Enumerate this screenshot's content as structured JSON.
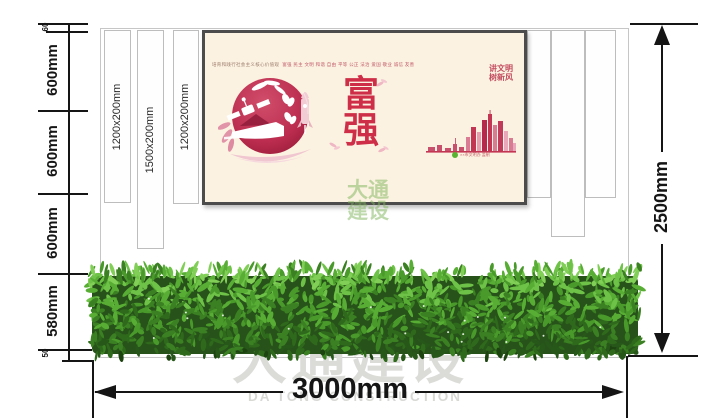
{
  "structure": {
    "slats": [
      {
        "label": "1200x200mm"
      },
      {
        "label": "1500x200mm"
      },
      {
        "label": "1200x200mm"
      }
    ]
  },
  "dimensions": {
    "left_top_small": "60",
    "left_segments": [
      "600mm",
      "600mm",
      "600mm",
      "580mm"
    ],
    "left_bottom_small": "50",
    "right_total": "2500mm",
    "bottom_total": "3000mm"
  },
  "poster": {
    "values_intro": "培育和践行社会主义核心价值观",
    "values_list": "富强 民主 文明 和谐 自由 平等 公正 法治 爱国 敬业 诚信 友善",
    "slogan": [
      "讲文明",
      "树新风"
    ],
    "main_word_top": "富",
    "main_word_bottom": "强",
    "credit": "××市文明办 监制"
  },
  "watermark": {
    "company_cn": "大通建设",
    "company_en": "DA TONG CONSTRUCTION",
    "poster_line1": "大通",
    "poster_line2": "建设"
  },
  "colors": {
    "crimson": "#c23553",
    "poster_red": "#ce2e47",
    "poster_bg": "#fcf2e1",
    "badge_green": "#59b331",
    "hedge_green": "#3b8022",
    "watermark_gray": "#dbdbd8",
    "watermark_green": "#8fbf77",
    "dimension_ink": "#151515"
  }
}
